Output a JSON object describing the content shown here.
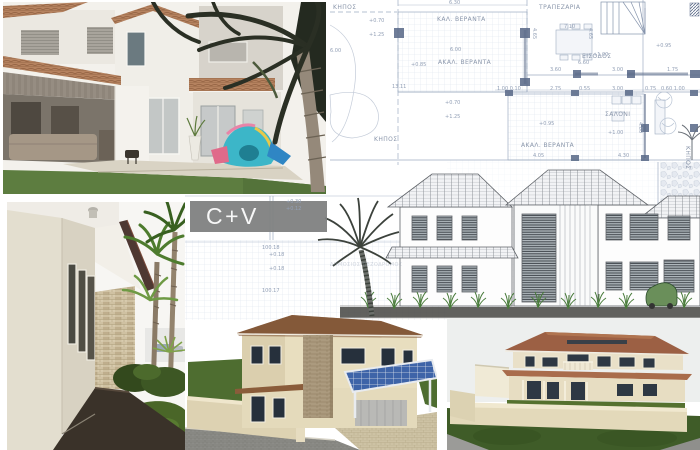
{
  "logo": {
    "text": "C+V",
    "bg_color": "#7e7f80",
    "text_color": "#f7f7f7"
  },
  "plan": {
    "rooms": [
      {
        "text": "ΚΗΠΟΣ"
      },
      {
        "text": "ΚΑΛ. ΒΕΡΑΝΤΑ"
      },
      {
        "text": "ΤΡΑΠΕΖΑΡΙΑ"
      },
      {
        "text": "ΑΚΑΛ. ΒΕΡΑΝΤΑ"
      },
      {
        "text": "ΕΙΣΟΔΟΣ"
      },
      {
        "text": "ΚΗΠΟΣ"
      },
      {
        "text": "ΑΚΑΛ. ΒΕΡΑΝΤΑ"
      },
      {
        "text": "ΣΑΛΟΝΙ"
      },
      {
        "text": "ΚΗΠΟΣ"
      },
      {
        "text": "ΔΗΜΟΣΙΟΣ ΠΕΖΟΔΡΟΜΟΣ"
      }
    ],
    "dims": [
      {
        "text": "6.30"
      },
      {
        "text": "7.10"
      },
      {
        "text": "6.00"
      },
      {
        "text": "6.00"
      },
      {
        "text": "13.11"
      },
      {
        "text": "6.60"
      },
      {
        "text": "3.60"
      },
      {
        "text": "3.00"
      },
      {
        "text": "1.75"
      },
      {
        "text": "1.00 0.10"
      },
      {
        "text": "2.75"
      },
      {
        "text": "0.55"
      },
      {
        "text": "3.00"
      },
      {
        "text": "0.75"
      },
      {
        "text": "0.60 1.00"
      },
      {
        "text": "+0.70"
      },
      {
        "text": "+1.25"
      },
      {
        "text": "+0.85"
      },
      {
        "text": "+1.00"
      },
      {
        "text": "+0.95"
      },
      {
        "text": "+0.70"
      },
      {
        "text": "+1.25"
      },
      {
        "text": "+0.95"
      },
      {
        "text": "+1.00"
      },
      {
        "text": "4.65"
      },
      {
        "text": "4.65"
      },
      {
        "text": "4.80"
      },
      {
        "text": "4.05"
      },
      {
        "text": "4.30"
      },
      {
        "text": "100.18"
      },
      {
        "text": "+0.18"
      },
      {
        "text": "+0.18"
      },
      {
        "text": "100.17"
      },
      {
        "text": "+0.30"
      },
      {
        "text": "+0.12"
      }
    ]
  },
  "palette": {
    "plan_line": "#9fadc2",
    "logo_gray": "#7e7f80",
    "photo_roof_terracotta": "#b5825f",
    "render_roof_brown": "#8a5c38",
    "render_roof_terracotta": "#9c6044",
    "solar_panel_blue": "#3e64a8",
    "lawn_green": "#5d7d40",
    "pencil_sketch_gray": "#5f6368",
    "play_tent_teal": "#3cb6c8"
  }
}
